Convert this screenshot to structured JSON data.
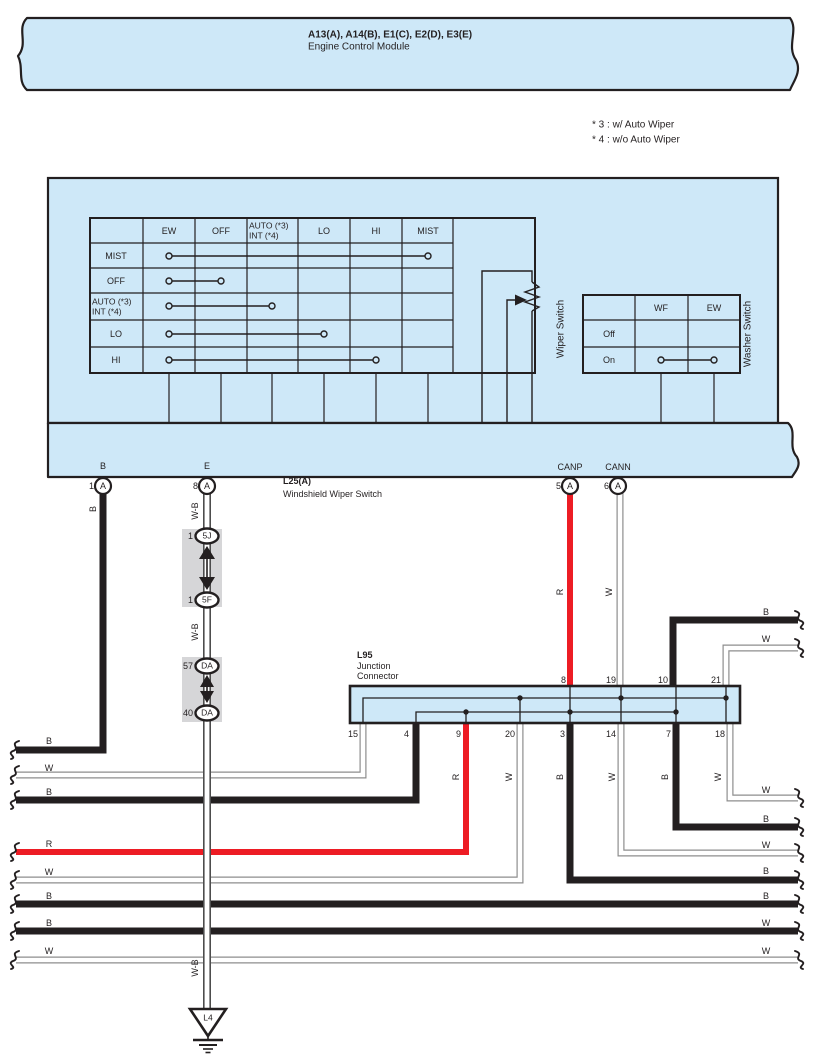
{
  "banner": {
    "title": "A13(A), A14(B), E1(C), E2(D), E3(E)",
    "subtitle": "Engine Control Module"
  },
  "note": {
    "l1": "* 3 : w/ Auto Wiper",
    "l2": "* 4 : w/o Auto Wiper"
  },
  "wiper": {
    "name": "Wiper Switch",
    "c_ew": "EW",
    "c_off": "OFF",
    "c_auto1": "AUTO (*3)",
    "c_auto2": "INT (*4)",
    "c_lo": "LO",
    "c_hi": "HI",
    "c_mist": "MIST",
    "r_mist": "MIST",
    "r_off": "OFF",
    "r_auto1": "AUTO (*3)",
    "r_auto2": "INT (*4)",
    "r_lo": "LO",
    "r_hi": "HI"
  },
  "washer": {
    "name": "Washer Switch",
    "c_wf": "WF",
    "c_ew": "EW",
    "r_off": "Off",
    "r_on": "On"
  },
  "l25": {
    "code": "L25(A)",
    "desc": "Windshield Wiper Switch",
    "b": {
      "num": "1",
      "conn": "A",
      "label": "B"
    },
    "e": {
      "num": "8",
      "conn": "A",
      "label": "E"
    },
    "canp": {
      "num": "5",
      "conn": "A",
      "label": "CANP"
    },
    "cann": {
      "num": "6",
      "conn": "A",
      "label": "CANN"
    }
  },
  "inline": {
    "j1": {
      "num": "1",
      "code": "5J"
    },
    "j2": {
      "num": "1",
      "code": "5F"
    },
    "d1": {
      "num": "57",
      "code": "DA"
    },
    "d2": {
      "num": "40",
      "code": "DA"
    }
  },
  "l95": {
    "code": "L95",
    "d1": "Junction",
    "d2": "Connector",
    "top": [
      "8",
      "19",
      "10",
      "21"
    ],
    "bottom": [
      "15",
      "4",
      "9",
      "20",
      "3",
      "14",
      "7",
      "18"
    ]
  },
  "ground": {
    "code": "L4"
  },
  "wires": {
    "v_b": "B",
    "v_wb": "W-B",
    "v_canp_r": "R",
    "v_cann_w": "W",
    "v9_r": "R",
    "v20_w": "W",
    "v3_b": "B",
    "v14_w": "W",
    "v7_b": "B",
    "v18_w": "W",
    "left": [
      "B",
      "W",
      "B",
      "R",
      "W",
      "B",
      "B",
      "W"
    ],
    "right": [
      "B",
      "W",
      "W",
      "B",
      "W",
      "B",
      "B",
      "W"
    ]
  },
  "colors": {
    "panel_blue": "#cee8f8",
    "line_black": "#231f20",
    "wire_red": "#ed1c24",
    "connector_gray": "#d6d6d8",
    "white_wire_outline": "#8d8d8d"
  }
}
